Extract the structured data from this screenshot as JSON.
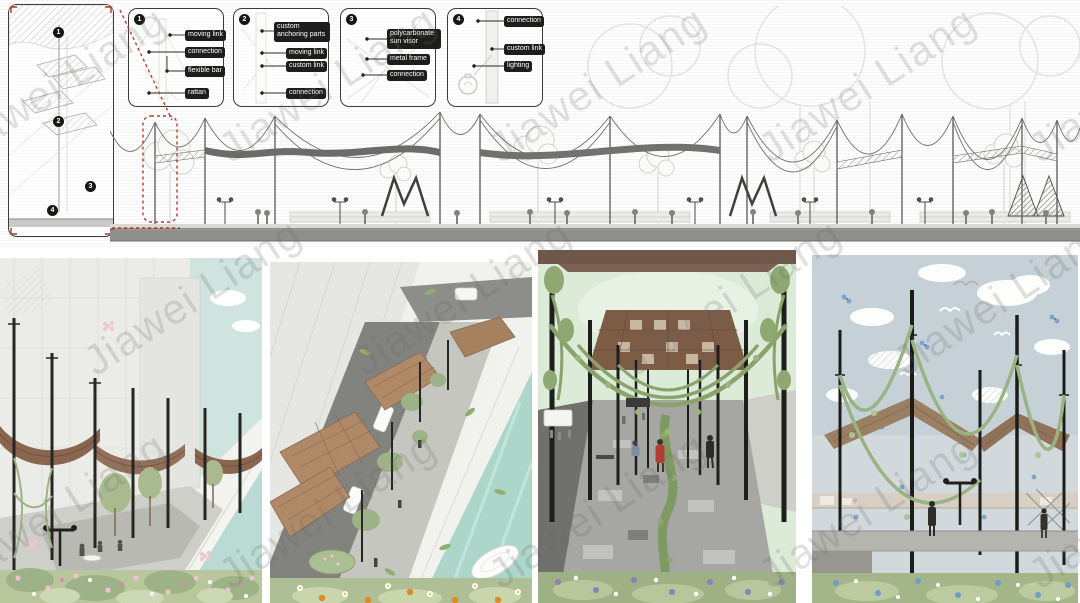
{
  "board": {
    "watermark": {
      "text": "Jiawei Liang"
    },
    "axon_panel": {
      "markers": [
        "1",
        "2",
        "3",
        "4"
      ]
    },
    "detail_panels": [
      {
        "number": "1",
        "labels": [
          "moving link",
          "connection",
          "flexible bar",
          "rattan"
        ]
      },
      {
        "number": "2",
        "labels": [
          "custom anchoring parts",
          "moving link",
          "custom link",
          "connection"
        ]
      },
      {
        "number": "3",
        "labels": [
          "polycarbonate sun visor",
          "metal frame",
          "connection"
        ]
      },
      {
        "number": "4",
        "labels": [
          "connection",
          "custom link",
          "lighting"
        ]
      }
    ],
    "colors": {
      "label_badge_bg": "#1d1d1b",
      "label_badge_text": "#ffffff",
      "annotation_red": "#c0392b",
      "canopy_brown": "#8a6550",
      "canal_teal": "#aed6c9",
      "sky_mint": "#dcead8",
      "sky_blue": "#c6d0d7",
      "meadow_green": "#a3b589",
      "pole_black": "#262624",
      "watermark_gray": "#a8a8a8"
    }
  }
}
